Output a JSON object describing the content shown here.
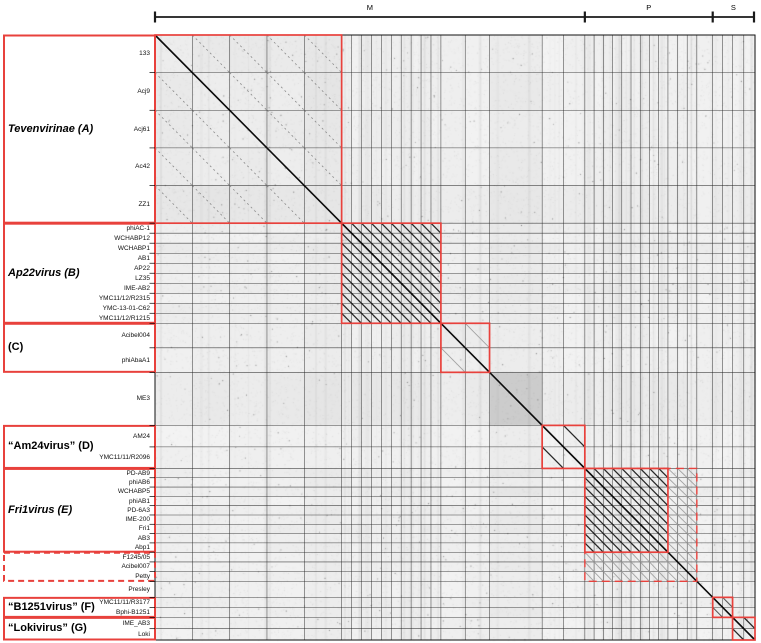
{
  "colors": {
    "box_red": "#e8413c",
    "grid": "#262626",
    "diagonal": "#0b0b0b",
    "axis": "#1a1a1a",
    "background": "#ffffff"
  },
  "chart_data": {
    "type": "heatmap",
    "subtype": "genome-dotplot-similarity-matrix",
    "top_axis": {
      "segments": [
        {
          "label": "M",
          "from_group": 0,
          "to_group": 4
        },
        {
          "label": "P",
          "from_group": 5,
          "to_group": 7
        },
        {
          "label": "S",
          "from_group": 8,
          "to_group": 9
        }
      ]
    },
    "groups": [
      {
        "name": "Tevenvirinae (A)",
        "italic": true,
        "label_box": "solid",
        "diag_box": "solid",
        "hatch": "faint",
        "members": [
          "133",
          "Acj9",
          "Acj61",
          "Ac42",
          "ZZ1"
        ],
        "relative_size": 37.6,
        "shade": [
          2,
          2,
          2,
          2,
          5
        ],
        "block_tint": 5
      },
      {
        "name": "Ap22virus (B)",
        "italic": true,
        "label_box": "solid",
        "diag_box": "solid",
        "hatch": "dense",
        "members": [
          "phiAC-1",
          "WCHABP12",
          "WCHABP1",
          "AB1",
          "AP22",
          "LZ35",
          "IME-AB2",
          "YMC11/12/R2315",
          "YMC-13-01-C62",
          "YMC11/12/R1215"
        ],
        "relative_size": 10,
        "shade": [
          4,
          3,
          5,
          3,
          4,
          3,
          5,
          3,
          4,
          3
        ],
        "block_tint": 0
      },
      {
        "name": "(C)",
        "italic": false,
        "label_box": "solid",
        "diag_box": "solid",
        "hatch": "light",
        "members": [
          "Acibel004",
          "phiAbaA1"
        ],
        "relative_size": 24.5,
        "shade": [
          2,
          2
        ],
        "block_tint": 3
      },
      {
        "name": "",
        "italic": false,
        "label_box": "none",
        "diag_box": "none",
        "hatch": "none",
        "members": [
          "ME3"
        ],
        "relative_size": 53,
        "shade": [
          6
        ],
        "block_tint": 26
      },
      {
        "name": "“Am24virus” (D)",
        "italic": false,
        "label_box": "solid",
        "diag_box": "solid",
        "hatch": "dense",
        "members": [
          "AM24",
          "YMC11/11/R2096"
        ],
        "relative_size": 21.5,
        "shade": [
          1,
          1
        ],
        "block_tint": 1
      },
      {
        "name": "Fri1virus (E)",
        "italic": true,
        "label_box": "solid",
        "diag_box": "solid",
        "hatch": "dense",
        "members": [
          "PD-AB9",
          "phiAB6",
          "WCHABP5",
          "phiAB1",
          "PD-6A3",
          "IME-200",
          "Fri1",
          "AB3",
          "Abp1"
        ],
        "relative_size": 9.3,
        "shade": [
          3,
          2,
          4,
          2,
          3,
          2,
          4,
          2,
          3
        ],
        "block_tint": 0
      },
      {
        "name": "",
        "italic": false,
        "label_box": "dashed",
        "diag_box": "none",
        "hatch": "light",
        "members": [
          "F1245/05",
          "Acibel007",
          "Petty"
        ],
        "relative_size": 9.7,
        "shade": [
          2,
          2,
          2
        ],
        "block_tint": 2
      },
      {
        "name": "",
        "italic": false,
        "label_box": "none",
        "diag_box": "none",
        "hatch": "none",
        "members": [
          "Presley"
        ],
        "relative_size": 16,
        "shade": [
          1
        ],
        "block_tint": 0
      },
      {
        "name": "“B1251virus” (F)",
        "italic": false,
        "label_box": "solid",
        "diag_box": "solid",
        "hatch": "medium",
        "members": [
          "YMC11/11/R3177",
          "Bphi-B1251"
        ],
        "relative_size": 10,
        "shade": [
          3,
          2
        ],
        "block_tint": 1
      },
      {
        "name": "“Lokivirus” (G)",
        "italic": false,
        "label_box": "solid",
        "diag_box": "solid",
        "hatch": "dense",
        "members": [
          "IME_AB3",
          "Loki"
        ],
        "relative_size": 11.3,
        "shade": [
          2,
          2
        ],
        "block_tint": 2
      }
    ],
    "dashed_overlay": {
      "from_group": 5,
      "to_group": 6,
      "style": "dashed"
    }
  }
}
